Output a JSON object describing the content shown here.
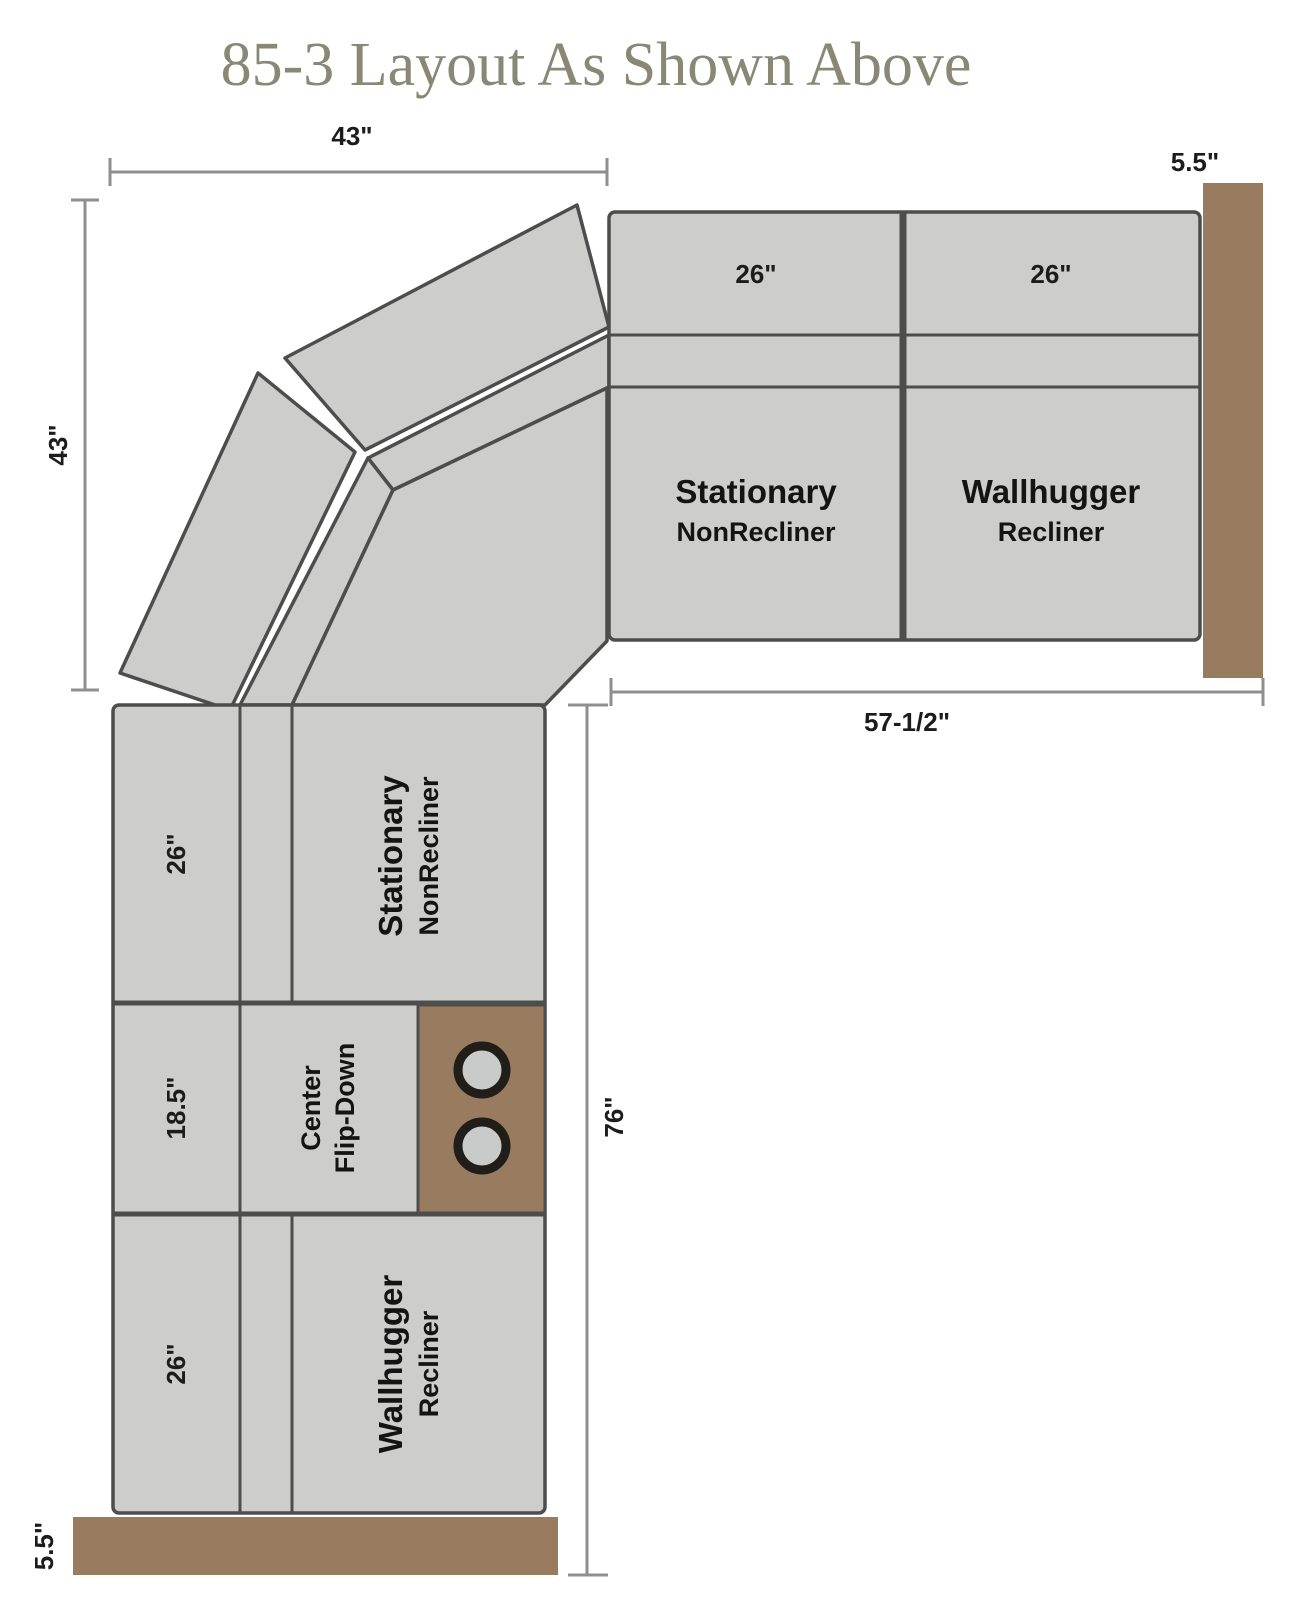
{
  "title": "85-3  Layout As Shown Above",
  "colors": {
    "background": "#ffffff",
    "title": "#8b8775",
    "unit_fill": "#cdcdcc",
    "unit_stroke": "#4d4d4d",
    "wall": "#997c5f",
    "dim_line": "#8f8f8f",
    "dim_text": "#1c1c1c",
    "label_text": "#141414",
    "cupholder_ring": "#211e1a",
    "cupholder_fill": "#c9cbca"
  },
  "dims": {
    "top_width": "43\"",
    "left_height": "43\"",
    "right_wall_depth": "5.5\"",
    "right_run_width": "57-1/2\"",
    "left_run_height": "76\"",
    "bottom_wall_depth": "5.5\""
  },
  "units": {
    "right_back_left": "26\"",
    "right_back_right": "26\"",
    "right_seat_left": {
      "line1": "Stationary",
      "line2": "NonRecliner"
    },
    "right_seat_right": {
      "line1": "Wallhugger",
      "line2": "Recliner"
    },
    "left_top_back": "26\"",
    "left_top_seat": {
      "line1": "Stationary",
      "line2": "NonRecliner"
    },
    "left_mid_back": "18.5\"",
    "left_mid_seat": {
      "line1": "Center",
      "line2": "Flip-Down"
    },
    "left_bottom_back": "26\"",
    "left_bottom_seat": {
      "line1": "Wallhugger",
      "line2": "Recliner"
    }
  }
}
